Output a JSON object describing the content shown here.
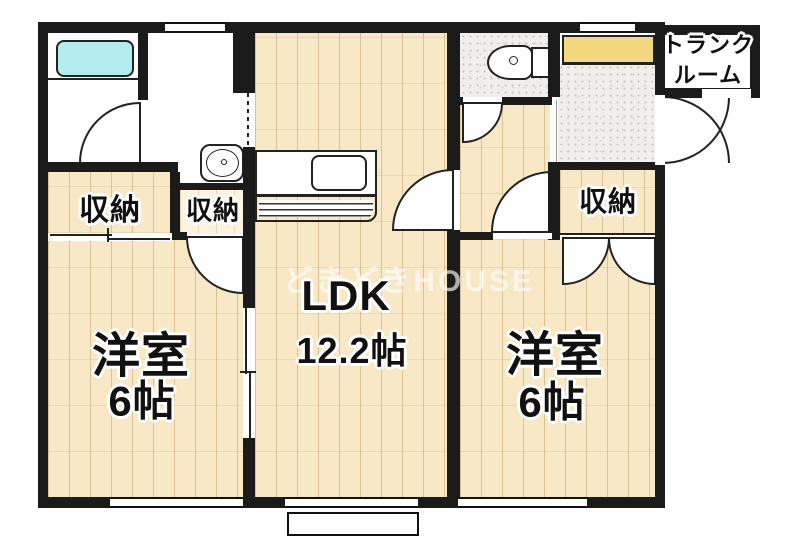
{
  "floorplan": {
    "watermark": "どきどきHOUSE",
    "trunk_room": {
      "line1": "トランク",
      "line2": "ルーム"
    },
    "rooms": {
      "ldk": {
        "name": "LDK",
        "size": "12.2帖"
      },
      "bedroom_left": {
        "name": "洋室",
        "size": "6帖"
      },
      "bedroom_right": {
        "name": "洋室",
        "size": "6帖"
      }
    },
    "closets": {
      "left_wide": "収納",
      "left_narrow": "収納",
      "right": "収納"
    },
    "colors": {
      "wall": "#1b1b1b",
      "wood_floor": "#f8e8c5",
      "bathtub": "#b4ecee",
      "shoe_cabinet": "#f2d87f",
      "tile_gray": "#f0efee"
    }
  }
}
